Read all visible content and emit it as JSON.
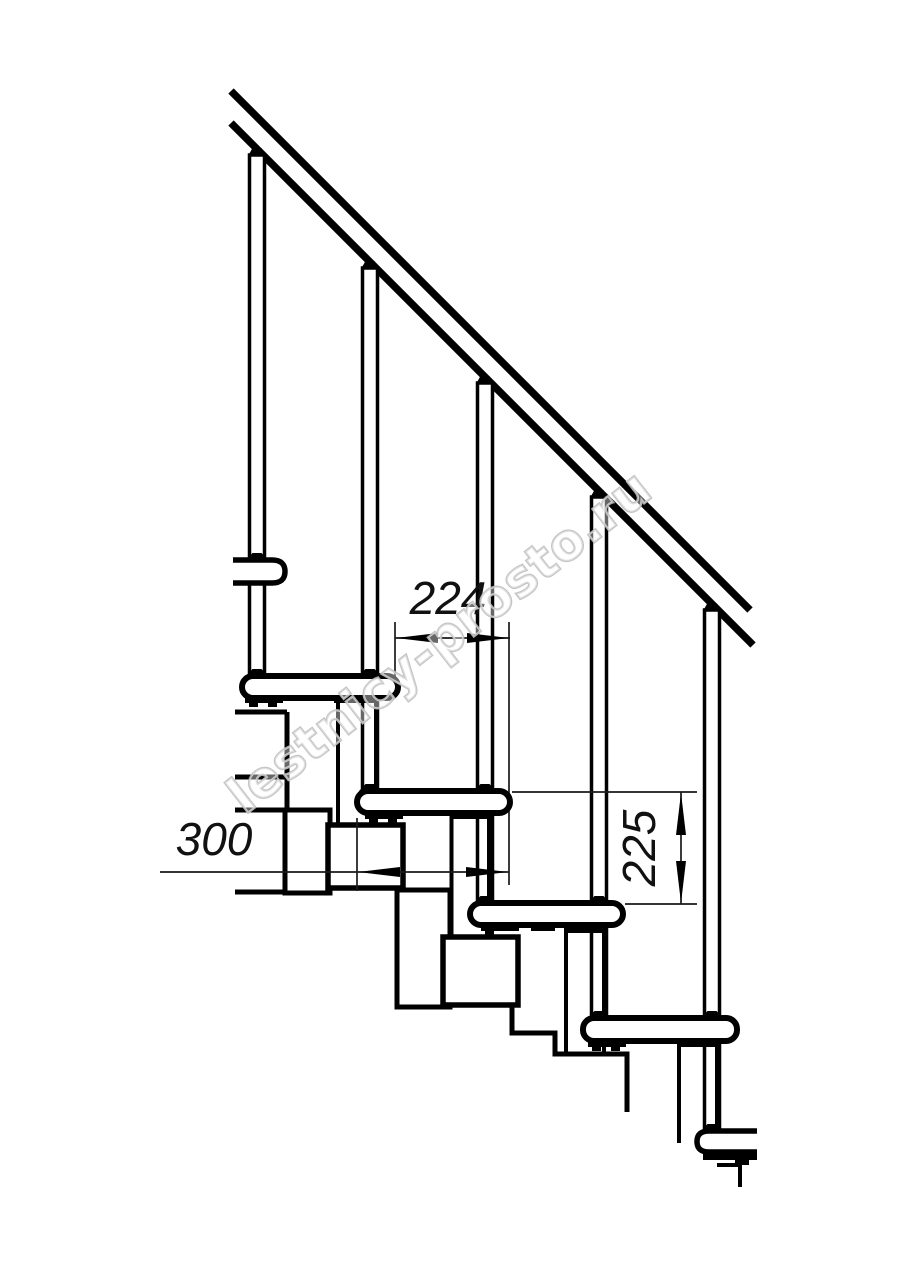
{
  "drawing": {
    "title": "staircase-side-view-fragment",
    "dimensions": {
      "tread_offset": "224",
      "tread_depth": "300",
      "riser_height": "225"
    },
    "watermark": {
      "text": "lestnicy-prosto.ru",
      "color": "#bfbfbf"
    },
    "colors": {
      "line": "#000000",
      "thin_line": "#1a1a1a",
      "background": "#ffffff"
    }
  }
}
